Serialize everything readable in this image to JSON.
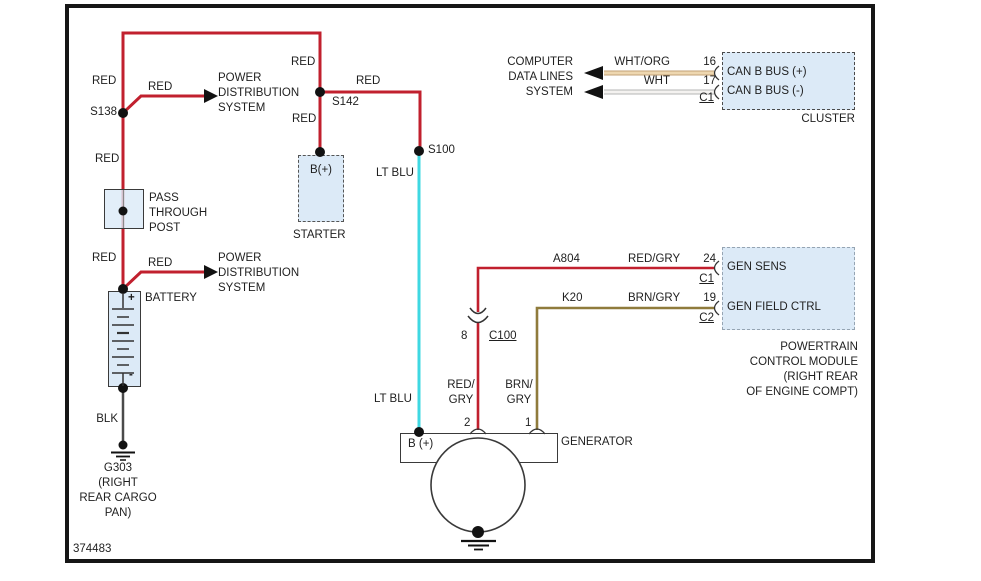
{
  "footer": {
    "diagram_number": "374483"
  },
  "colors": {
    "red": "#c1202e",
    "lt_blu": "#3fd8e2",
    "brn_gry": "#8f7b3c",
    "wht_org": "#ecd2a4",
    "wht": "#f2f0ee",
    "blk": "#4a4a4a",
    "component_fill": "#dceaf7"
  },
  "labels": {
    "red": "RED",
    "blk": "BLK",
    "lt_blu": "LT BLU",
    "wht_org": "WHT/ORG",
    "wht": "WHT",
    "red_gry": "RED/GRY",
    "brn_gry": "BRN/GRY",
    "red_gry_line1": "RED/",
    "brn_gry_line1": "BRN/",
    "gry_line2": "GRY"
  },
  "splices": {
    "s138": "S138",
    "s142": "S142",
    "s100": "S100"
  },
  "circuits": {
    "a804": "A804",
    "k20": "K20"
  },
  "pins": {
    "p16": "16",
    "p17": "17",
    "p24": "24",
    "p19": "19",
    "p8": "8",
    "p2": "2",
    "p1": "1",
    "c1": "C1",
    "c2": "C2",
    "c100": "C100"
  },
  "components": {
    "power_distribution": {
      "lines": [
        "POWER",
        "DISTRIBUTION",
        "SYSTEM"
      ]
    },
    "pass_through_post": {
      "lines": [
        "PASS",
        "THROUGH",
        "POST"
      ]
    },
    "battery": {
      "label": "BATTERY",
      "plus": "+",
      "minus": "-"
    },
    "starter": {
      "label": "STARTER",
      "terminal": "B(+)"
    },
    "computer_data_lines": {
      "lines": [
        "COMPUTER",
        "DATA LINES",
        "SYSTEM"
      ]
    },
    "cluster": {
      "label": "CLUSTER",
      "pin_labels": [
        "CAN B BUS (+)",
        "CAN B BUS (-)"
      ]
    },
    "pcm": {
      "pin_labels": [
        "GEN SENS",
        "GEN FIELD CTRL"
      ],
      "name_lines": [
        "POWERTRAIN",
        "CONTROL MODULE",
        "(RIGHT REAR",
        "OF ENGINE COMPT)"
      ]
    },
    "generator": {
      "label": "GENERATOR",
      "terminal": "B (+)"
    },
    "ground_g303": {
      "lines": [
        "G303",
        "(RIGHT",
        "REAR CARGO",
        "PAN)"
      ]
    }
  }
}
